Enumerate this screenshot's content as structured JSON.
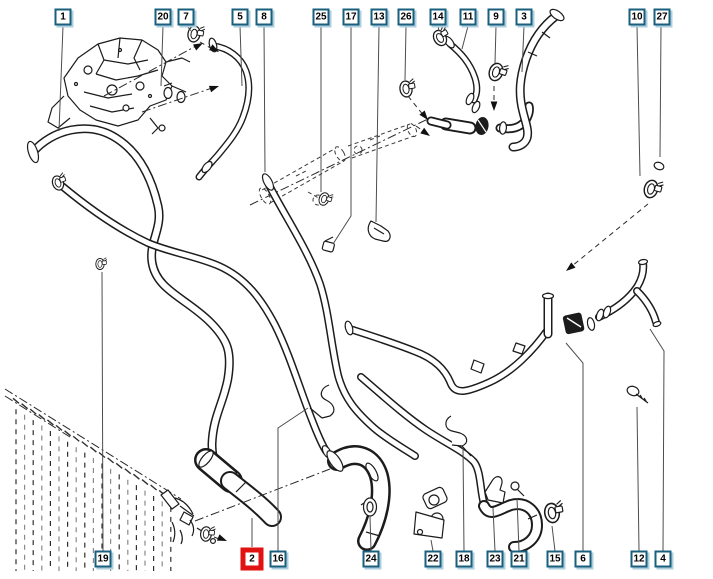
{
  "diagram": {
    "type": "exploded-parts-diagram",
    "subject": "engine cooling hoses and clamps",
    "canvas": {
      "width": 713,
      "height": 579,
      "background": "#ffffff"
    },
    "colors": {
      "callout_border": "#1a5f7d",
      "callout_shadow": "#aecfdd",
      "callout_background": "#ffffff",
      "callout_number": "#000000",
      "highlight_border": "#e11212",
      "leader_line": "#4d4d4d",
      "artwork_line": "#1c1c1c"
    },
    "selected_part": "2",
    "callouts": [
      {
        "number": "1",
        "x": 63,
        "y": 17,
        "highlighted": false,
        "leader": [
          [
            63,
            26
          ],
          [
            59,
            131
          ]
        ]
      },
      {
        "number": "20",
        "x": 163,
        "y": 17,
        "highlighted": false,
        "leader": [
          [
            163,
            26
          ],
          [
            161,
            86
          ]
        ]
      },
      {
        "number": "7",
        "x": 186,
        "y": 17,
        "highlighted": false,
        "leader": [
          [
            187,
            26
          ],
          [
            191,
            31
          ]
        ]
      },
      {
        "number": "5",
        "x": 240,
        "y": 17,
        "highlighted": false,
        "leader": [
          [
            240,
            26
          ],
          [
            242,
            86
          ]
        ]
      },
      {
        "number": "8",
        "x": 264,
        "y": 17,
        "highlighted": false,
        "leader": [
          [
            264,
            26
          ],
          [
            265,
            172
          ]
        ]
      },
      {
        "number": "25",
        "x": 321,
        "y": 17,
        "highlighted": false,
        "leader": [
          [
            321,
            26
          ],
          [
            321,
            192
          ]
        ]
      },
      {
        "number": "17",
        "x": 351,
        "y": 17,
        "highlighted": false,
        "leader": [
          [
            351,
            26
          ],
          [
            351,
            216
          ],
          [
            333,
            244
          ]
        ]
      },
      {
        "number": "13",
        "x": 379,
        "y": 17,
        "highlighted": false,
        "leader": [
          [
            379,
            26
          ],
          [
            376,
            222
          ]
        ]
      },
      {
        "number": "26",
        "x": 406,
        "y": 17,
        "highlighted": false,
        "leader": [
          [
            406,
            26
          ],
          [
            405,
            80
          ]
        ]
      },
      {
        "number": "14",
        "x": 438,
        "y": 17,
        "highlighted": false,
        "leader": [
          [
            438,
            26
          ],
          [
            439,
            31
          ]
        ]
      },
      {
        "number": "11",
        "x": 468,
        "y": 17,
        "highlighted": false,
        "leader": [
          [
            468,
            26
          ],
          [
            462,
            49
          ]
        ]
      },
      {
        "number": "9",
        "x": 496,
        "y": 17,
        "highlighted": false,
        "leader": [
          [
            496,
            26
          ],
          [
            495,
            63
          ]
        ]
      },
      {
        "number": "3",
        "x": 524,
        "y": 17,
        "highlighted": false,
        "leader": [
          [
            524,
            26
          ],
          [
            522,
            72
          ]
        ]
      },
      {
        "number": "10",
        "x": 637,
        "y": 17,
        "highlighted": false,
        "leader": [
          [
            637,
            26
          ],
          [
            640,
            176
          ]
        ]
      },
      {
        "number": "27",
        "x": 662,
        "y": 17,
        "highlighted": false,
        "leader": [
          [
            661,
            26
          ],
          [
            660,
            157
          ]
        ]
      },
      {
        "number": "19",
        "x": 103,
        "y": 559,
        "highlighted": false,
        "leader": [
          [
            103,
            551
          ],
          [
            102,
            272
          ]
        ]
      },
      {
        "number": "2",
        "x": 252,
        "y": 559,
        "highlighted": true,
        "leader": [
          [
            252,
            547
          ],
          [
            252,
            518
          ]
        ]
      },
      {
        "number": "16",
        "x": 278,
        "y": 559,
        "highlighted": false,
        "leader": [
          [
            278,
            551
          ],
          [
            278,
            428
          ],
          [
            308,
            408
          ]
        ]
      },
      {
        "number": "24",
        "x": 371,
        "y": 559,
        "highlighted": false,
        "leader": [
          [
            371,
            551
          ],
          [
            370,
            516
          ]
        ]
      },
      {
        "number": "22",
        "x": 433,
        "y": 559,
        "highlighted": false,
        "leader": [
          [
            433,
            551
          ],
          [
            431,
            540
          ]
        ]
      },
      {
        "number": "18",
        "x": 464,
        "y": 559,
        "highlighted": false,
        "leader": [
          [
            464,
            551
          ],
          [
            463,
            448
          ]
        ]
      },
      {
        "number": "23",
        "x": 495,
        "y": 559,
        "highlighted": false,
        "leader": [
          [
            495,
            551
          ],
          [
            493,
            508
          ]
        ]
      },
      {
        "number": "21",
        "x": 519,
        "y": 559,
        "highlighted": false,
        "leader": [
          [
            519,
            551
          ],
          [
            517,
            498
          ]
        ]
      },
      {
        "number": "15",
        "x": 555,
        "y": 559,
        "highlighted": false,
        "leader": [
          [
            555,
            551
          ],
          [
            552,
            526
          ]
        ]
      },
      {
        "number": "6",
        "x": 583,
        "y": 559,
        "highlighted": false,
        "leader": [
          [
            583,
            551
          ],
          [
            583,
            363
          ],
          [
            566,
            343
          ]
        ]
      },
      {
        "number": "12",
        "x": 639,
        "y": 559,
        "highlighted": false,
        "leader": [
          [
            639,
            551
          ],
          [
            637,
            407
          ]
        ]
      },
      {
        "number": "4",
        "x": 663,
        "y": 559,
        "highlighted": false,
        "leader": [
          [
            663,
            551
          ],
          [
            664,
            351
          ],
          [
            650,
            329
          ]
        ]
      }
    ]
  }
}
